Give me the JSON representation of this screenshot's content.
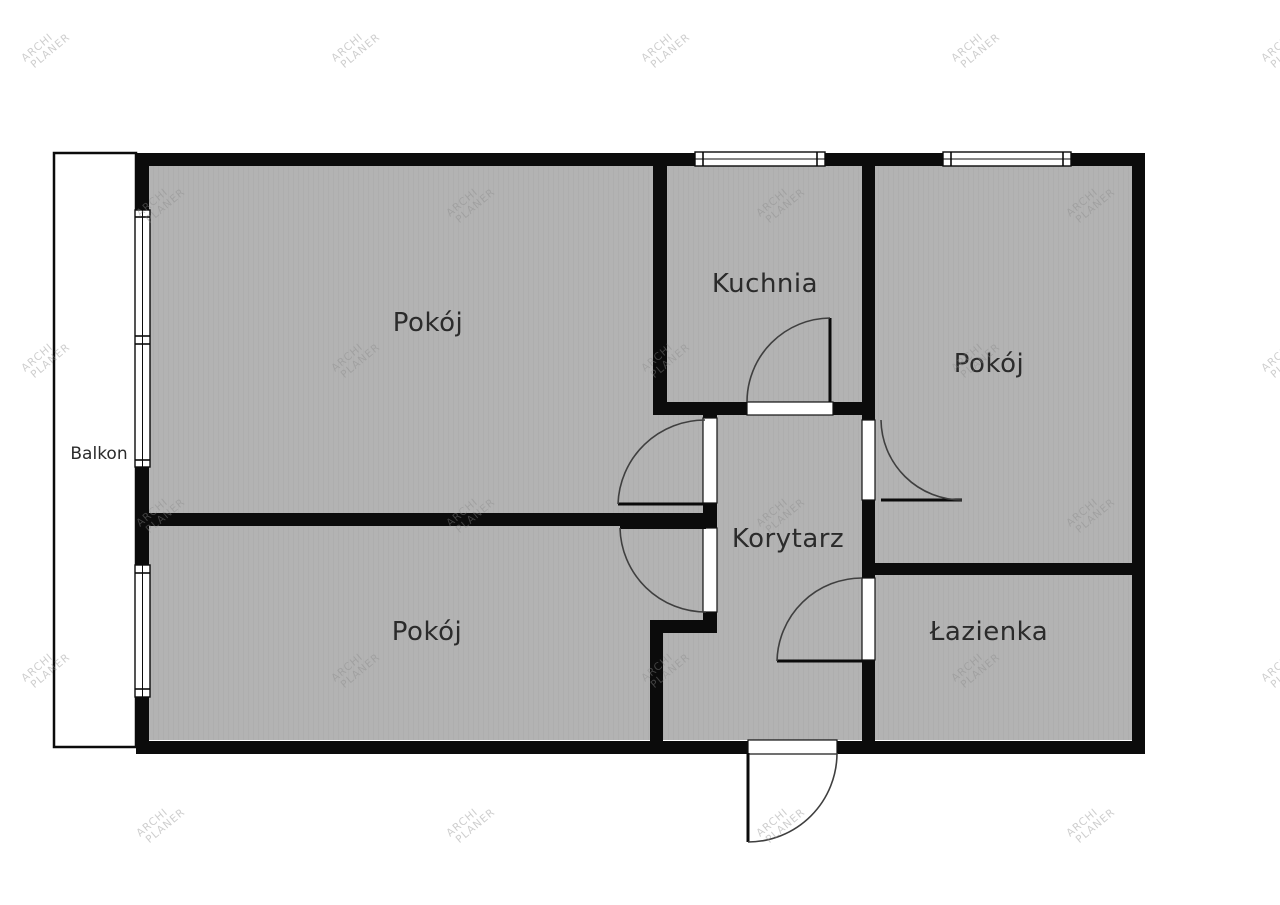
{
  "plan": {
    "type": "apartment-floor-plan",
    "watermark": {
      "line1": "ARCHI",
      "line2": "PLANER"
    },
    "colors": {
      "wall": "#0b0b0b",
      "room_fill": "#b3b3b3",
      "background": "#ffffff",
      "label": "#2b2b2b",
      "door_arc": "#3f3f3f",
      "watermark": "#8a8a8a"
    },
    "rooms": {
      "pokoj_tl": {
        "label": "Pokój"
      },
      "kuchnia": {
        "label": "Kuchnia"
      },
      "pokoj_tr": {
        "label": "Pokój"
      },
      "korytarz": {
        "label": "Korytarz"
      },
      "pokoj_bl": {
        "label": "Pokój"
      },
      "lazienka": {
        "label": "Łazienka"
      },
      "balkon": {
        "label": "Balkon"
      }
    }
  }
}
